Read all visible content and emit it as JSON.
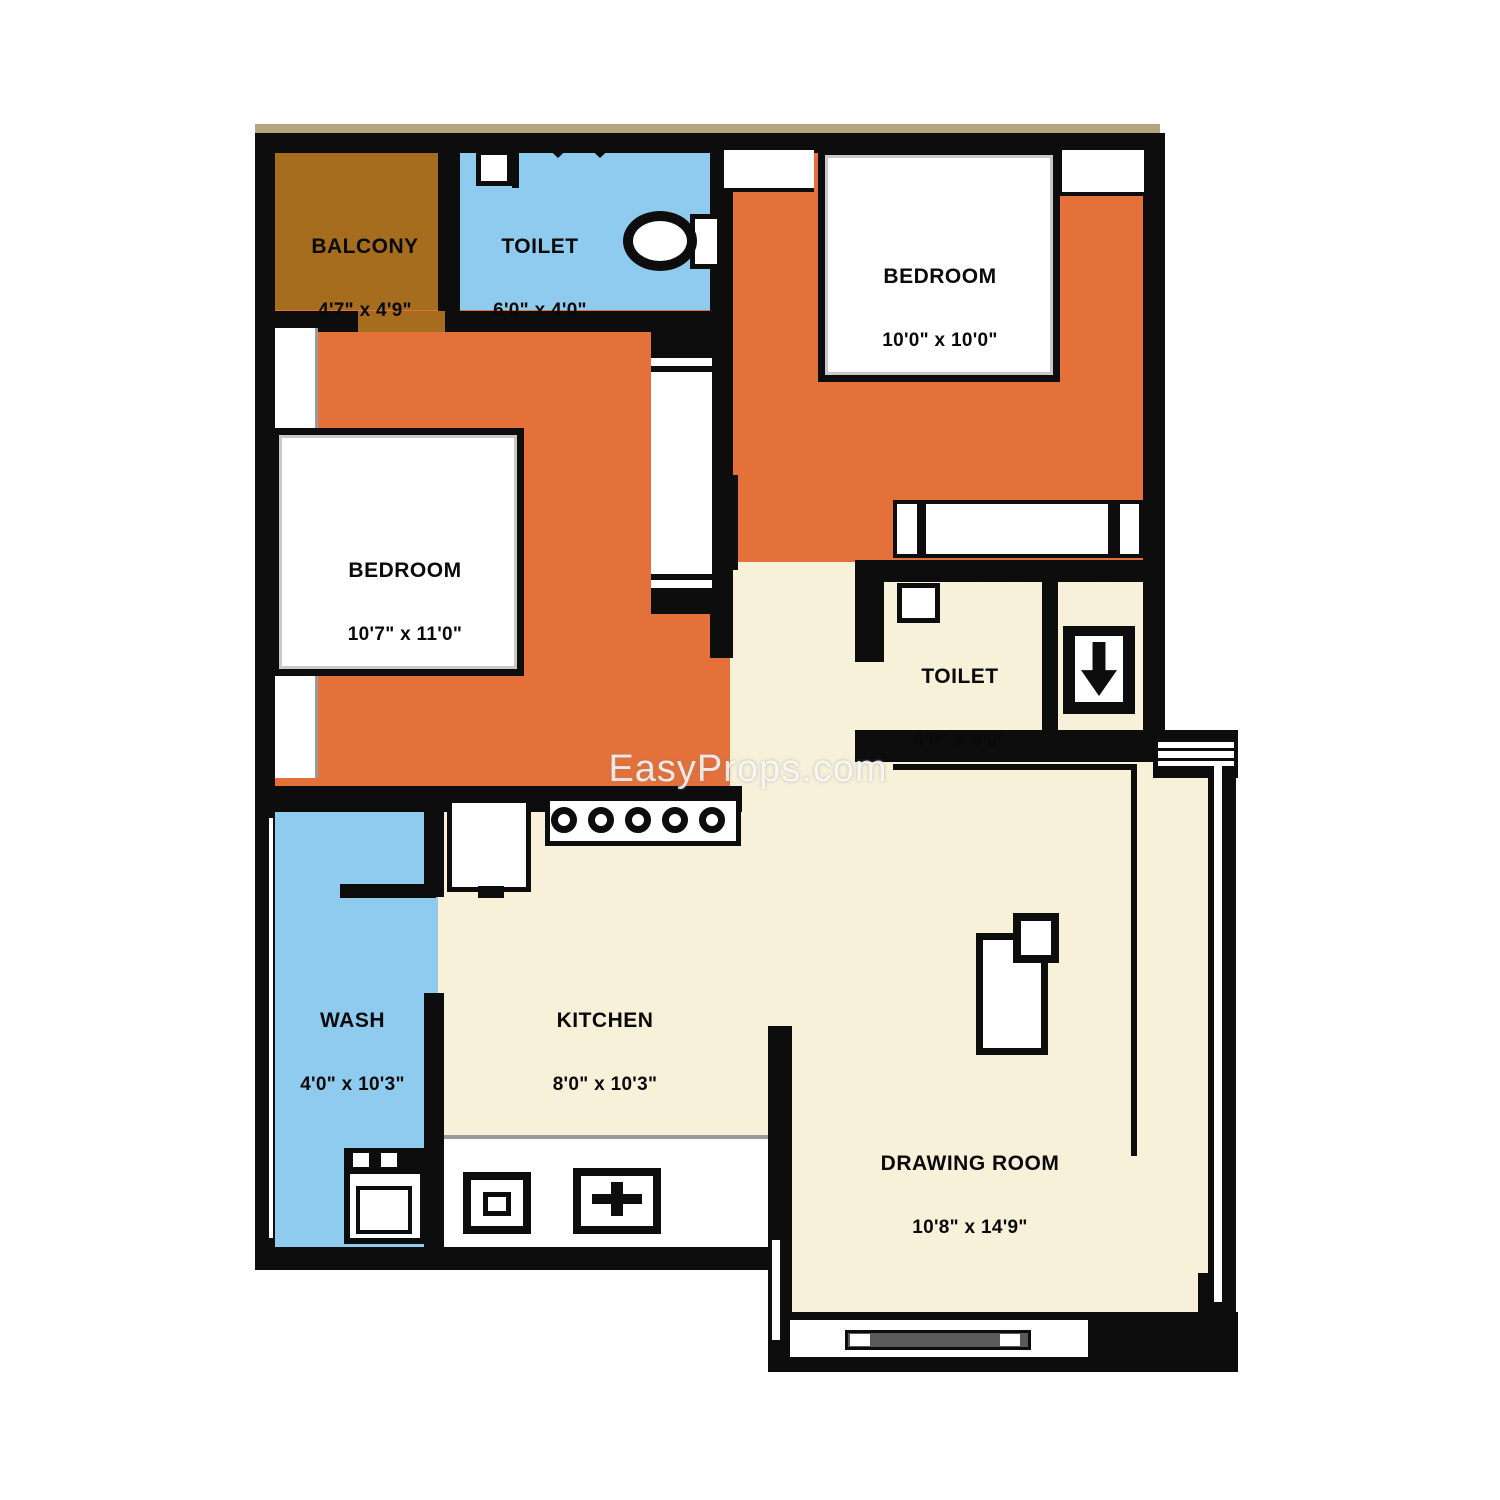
{
  "watermark": "EasyProps.com",
  "rooms": {
    "balcony": {
      "name": "BALCONY",
      "dims": "4'7\" x 4'9\""
    },
    "toilet_top": {
      "name": "TOILET",
      "dims": "6'0\" x 4'0\""
    },
    "bedroom_right": {
      "name": "BEDROOM",
      "dims": "10'0\" x 10'0\""
    },
    "bedroom_left": {
      "name": "BEDROOM",
      "dims": "10'7\" x 11'0\""
    },
    "toilet_mid": {
      "name": "TOILET",
      "dims": "6'0\" x 4'0\""
    },
    "wash": {
      "name": "WASH",
      "dims": "4'0\" x 10'3\""
    },
    "kitchen": {
      "name": "KITCHEN",
      "dims": "8'0\" x 10'3\""
    },
    "drawing": {
      "name": "DRAWING ROOM",
      "dims": "10'8\" x 14'9\""
    }
  },
  "colors": {
    "wall": "#0d0d0d",
    "balcony": "#a56d1d",
    "toilet": "#8fcbee",
    "bedroom": "#e5713a",
    "floor": "#f7f1da",
    "outside": "#ffffff",
    "trim": "#b3a67e",
    "window_bar": "#5a5a5a",
    "watermark_color": "rgba(255,255,255,0.8)"
  },
  "icons": {
    "bed": "white rectangle with black border",
    "wardrobe": "white band with dividers",
    "toilet-bowl": "black ring ellipse with cistern",
    "washbasin": "small white square",
    "door-swing": "black V mark",
    "stove-burners": "five circles",
    "sink": "box with faucet cross",
    "washing-machine": "box with two dispensers and drum",
    "sofa": "L-shaped line",
    "tv-unit": "rectangle with corner square",
    "window": "double white lines in wall"
  }
}
